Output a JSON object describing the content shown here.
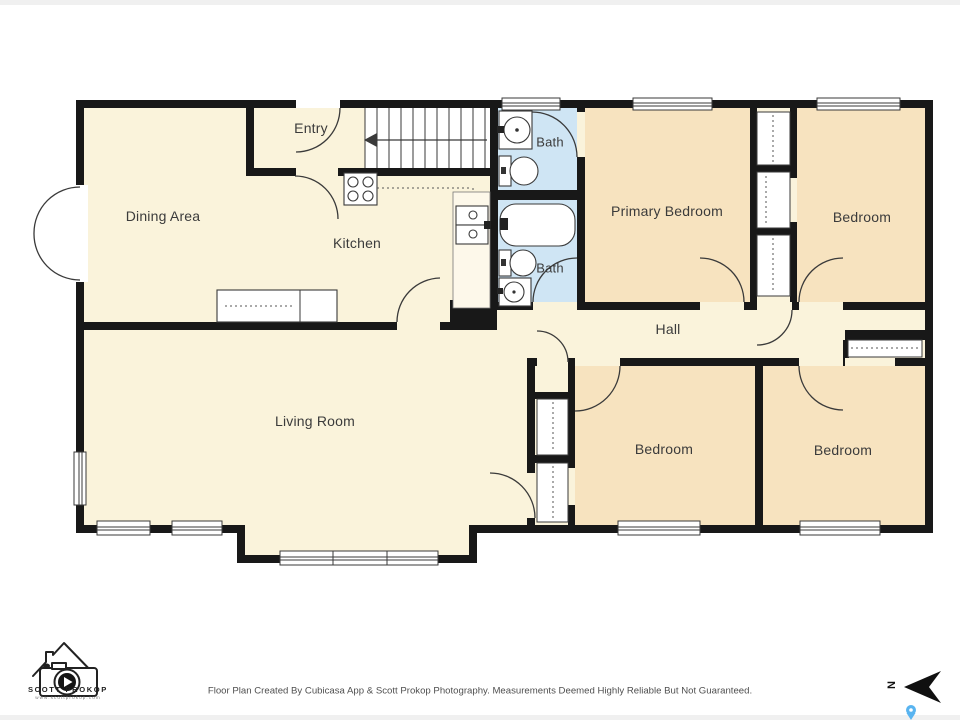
{
  "title": "Floor Plan",
  "rooms": {
    "dining": {
      "label": "Dining Area"
    },
    "entry": {
      "label": "Entry"
    },
    "kitchen": {
      "label": "Kitchen"
    },
    "bath_top": {
      "label": "Bath"
    },
    "bath_bottom": {
      "label": "Bath"
    },
    "primary_bedroom": {
      "label": "Primary Bedroom"
    },
    "bedroom_top_right": {
      "label": "Bedroom"
    },
    "hall": {
      "label": "Hall"
    },
    "bedroom_bottom_left": {
      "label": "Bedroom"
    },
    "bedroom_bottom_right": {
      "label": "Bedroom"
    },
    "living": {
      "label": "Living Room"
    }
  },
  "footer": {
    "disclaimer": "Floor Plan Created By Cubicasa App & Scott Prokop Photography. Measurements Deemed Highly Reliable But Not Guaranteed."
  },
  "logo": {
    "name": "SCOTT PROKOP",
    "url": "www.scottprokop.com"
  },
  "compass": {
    "north_label": "N"
  },
  "colors": {
    "floor_cream": "#faf3db",
    "bedroom_peach": "#f7e3bf",
    "bath_blue": "#cfe5f4",
    "wall_black": "#181818",
    "pin_blue": "#59b4f0"
  }
}
